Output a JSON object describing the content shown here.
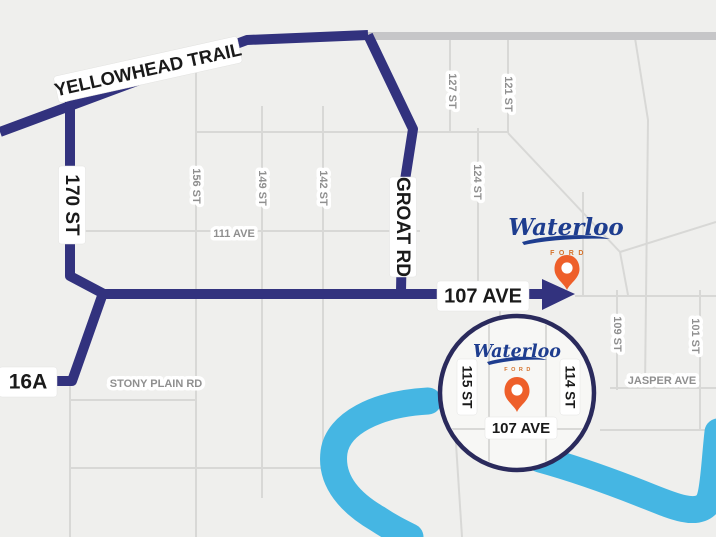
{
  "title": "Waterloo Ford directions map",
  "colors": {
    "background": "#efefed",
    "route_navy": "#32327e",
    "inset_ring_navy": "#2a2a5c",
    "river_blue": "#45b6e3",
    "minor_road_gray": "#d8d8d6",
    "major_road_gray": "#c6c6c8",
    "label_black": "#1a1a1a",
    "label_gray": "#8f8f8f",
    "pin_orange": "#ee5f2a",
    "logo_navy": "#1e3d8f",
    "logo_sub_orange": "#d4722c"
  },
  "routes": {
    "yellowhead_label": "YELLOWHEAD TRAIL",
    "st170_label": "170 ST",
    "groat_label": "GROAT RD",
    "hwy16a_label": "16A",
    "ave107_label": "107 AVE"
  },
  "streets": {
    "s156": "156 ST",
    "s149": "149 ST",
    "s142": "142 ST",
    "s127": "127 ST",
    "s121": "121 ST",
    "s124": "124 ST",
    "s109": "109 ST",
    "s101": "101 ST",
    "ave111": "111 AVE",
    "stony_plain": "STONY PLAIN RD",
    "jasper": "JASPER AVE"
  },
  "dealership": {
    "logo_text": "Waterloo",
    "logo_sub": "FORD"
  },
  "inset": {
    "logo_text": "Waterloo",
    "logo_sub": "FORD",
    "street_left": "115 ST",
    "street_right": "114 ST",
    "ave_label": "107 AVE"
  }
}
